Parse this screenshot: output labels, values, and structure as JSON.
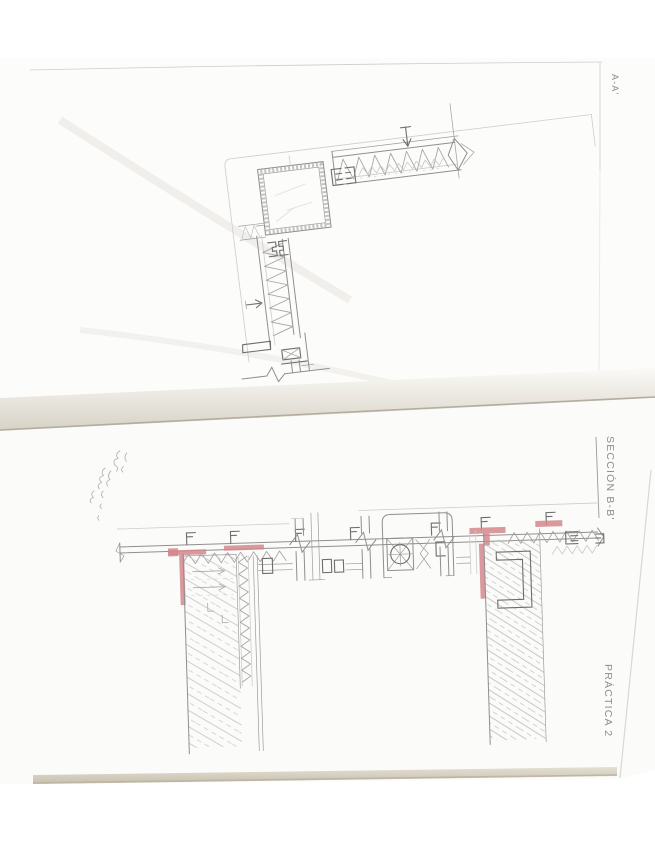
{
  "document": {
    "labels": {
      "top_right": "A-A'",
      "section": "SECCIÓN B-B'",
      "practice": "PRÁCTICA 2"
    },
    "handwritten_note": {
      "present": true,
      "legible": false
    },
    "colors": {
      "pencil": "#8f8f8f",
      "pencil_dark": "#6e6e6e",
      "red_highlight": "#d4878d",
      "paper": "#fcfcfb",
      "edge_shadow": "#b3ad9f"
    }
  }
}
